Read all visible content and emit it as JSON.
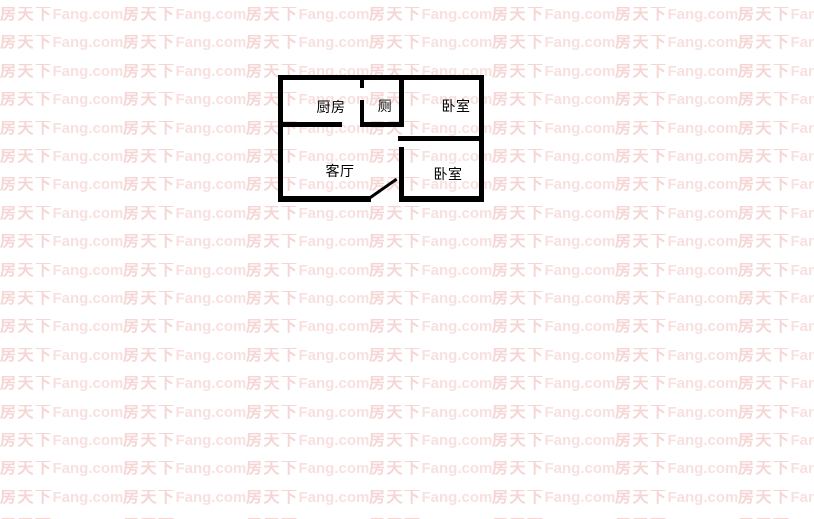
{
  "watermark": {
    "text_cn": "房天下",
    "text_latin": "Fang.com",
    "color_cn": "#f6d5d5",
    "color_latin": "#f9e0e0",
    "rows": 19,
    "cols": 7,
    "row_pitch": 28.4,
    "start_y": 7,
    "tile_width": 123
  },
  "floorplan": {
    "wall_color": "#000000",
    "rooms": [
      {
        "id": "kitchen",
        "label": "厨房",
        "cx": 331,
        "cy": 107
      },
      {
        "id": "toilet",
        "label": "厕",
        "cx": 385,
        "cy": 106
      },
      {
        "id": "bedroom-top",
        "label": "卧室",
        "cx": 456,
        "cy": 106
      },
      {
        "id": "living-room",
        "label": "客厅",
        "cx": 340,
        "cy": 171
      },
      {
        "id": "bedroom-bottom",
        "label": "卧室",
        "cx": 448,
        "cy": 174
      }
    ]
  }
}
